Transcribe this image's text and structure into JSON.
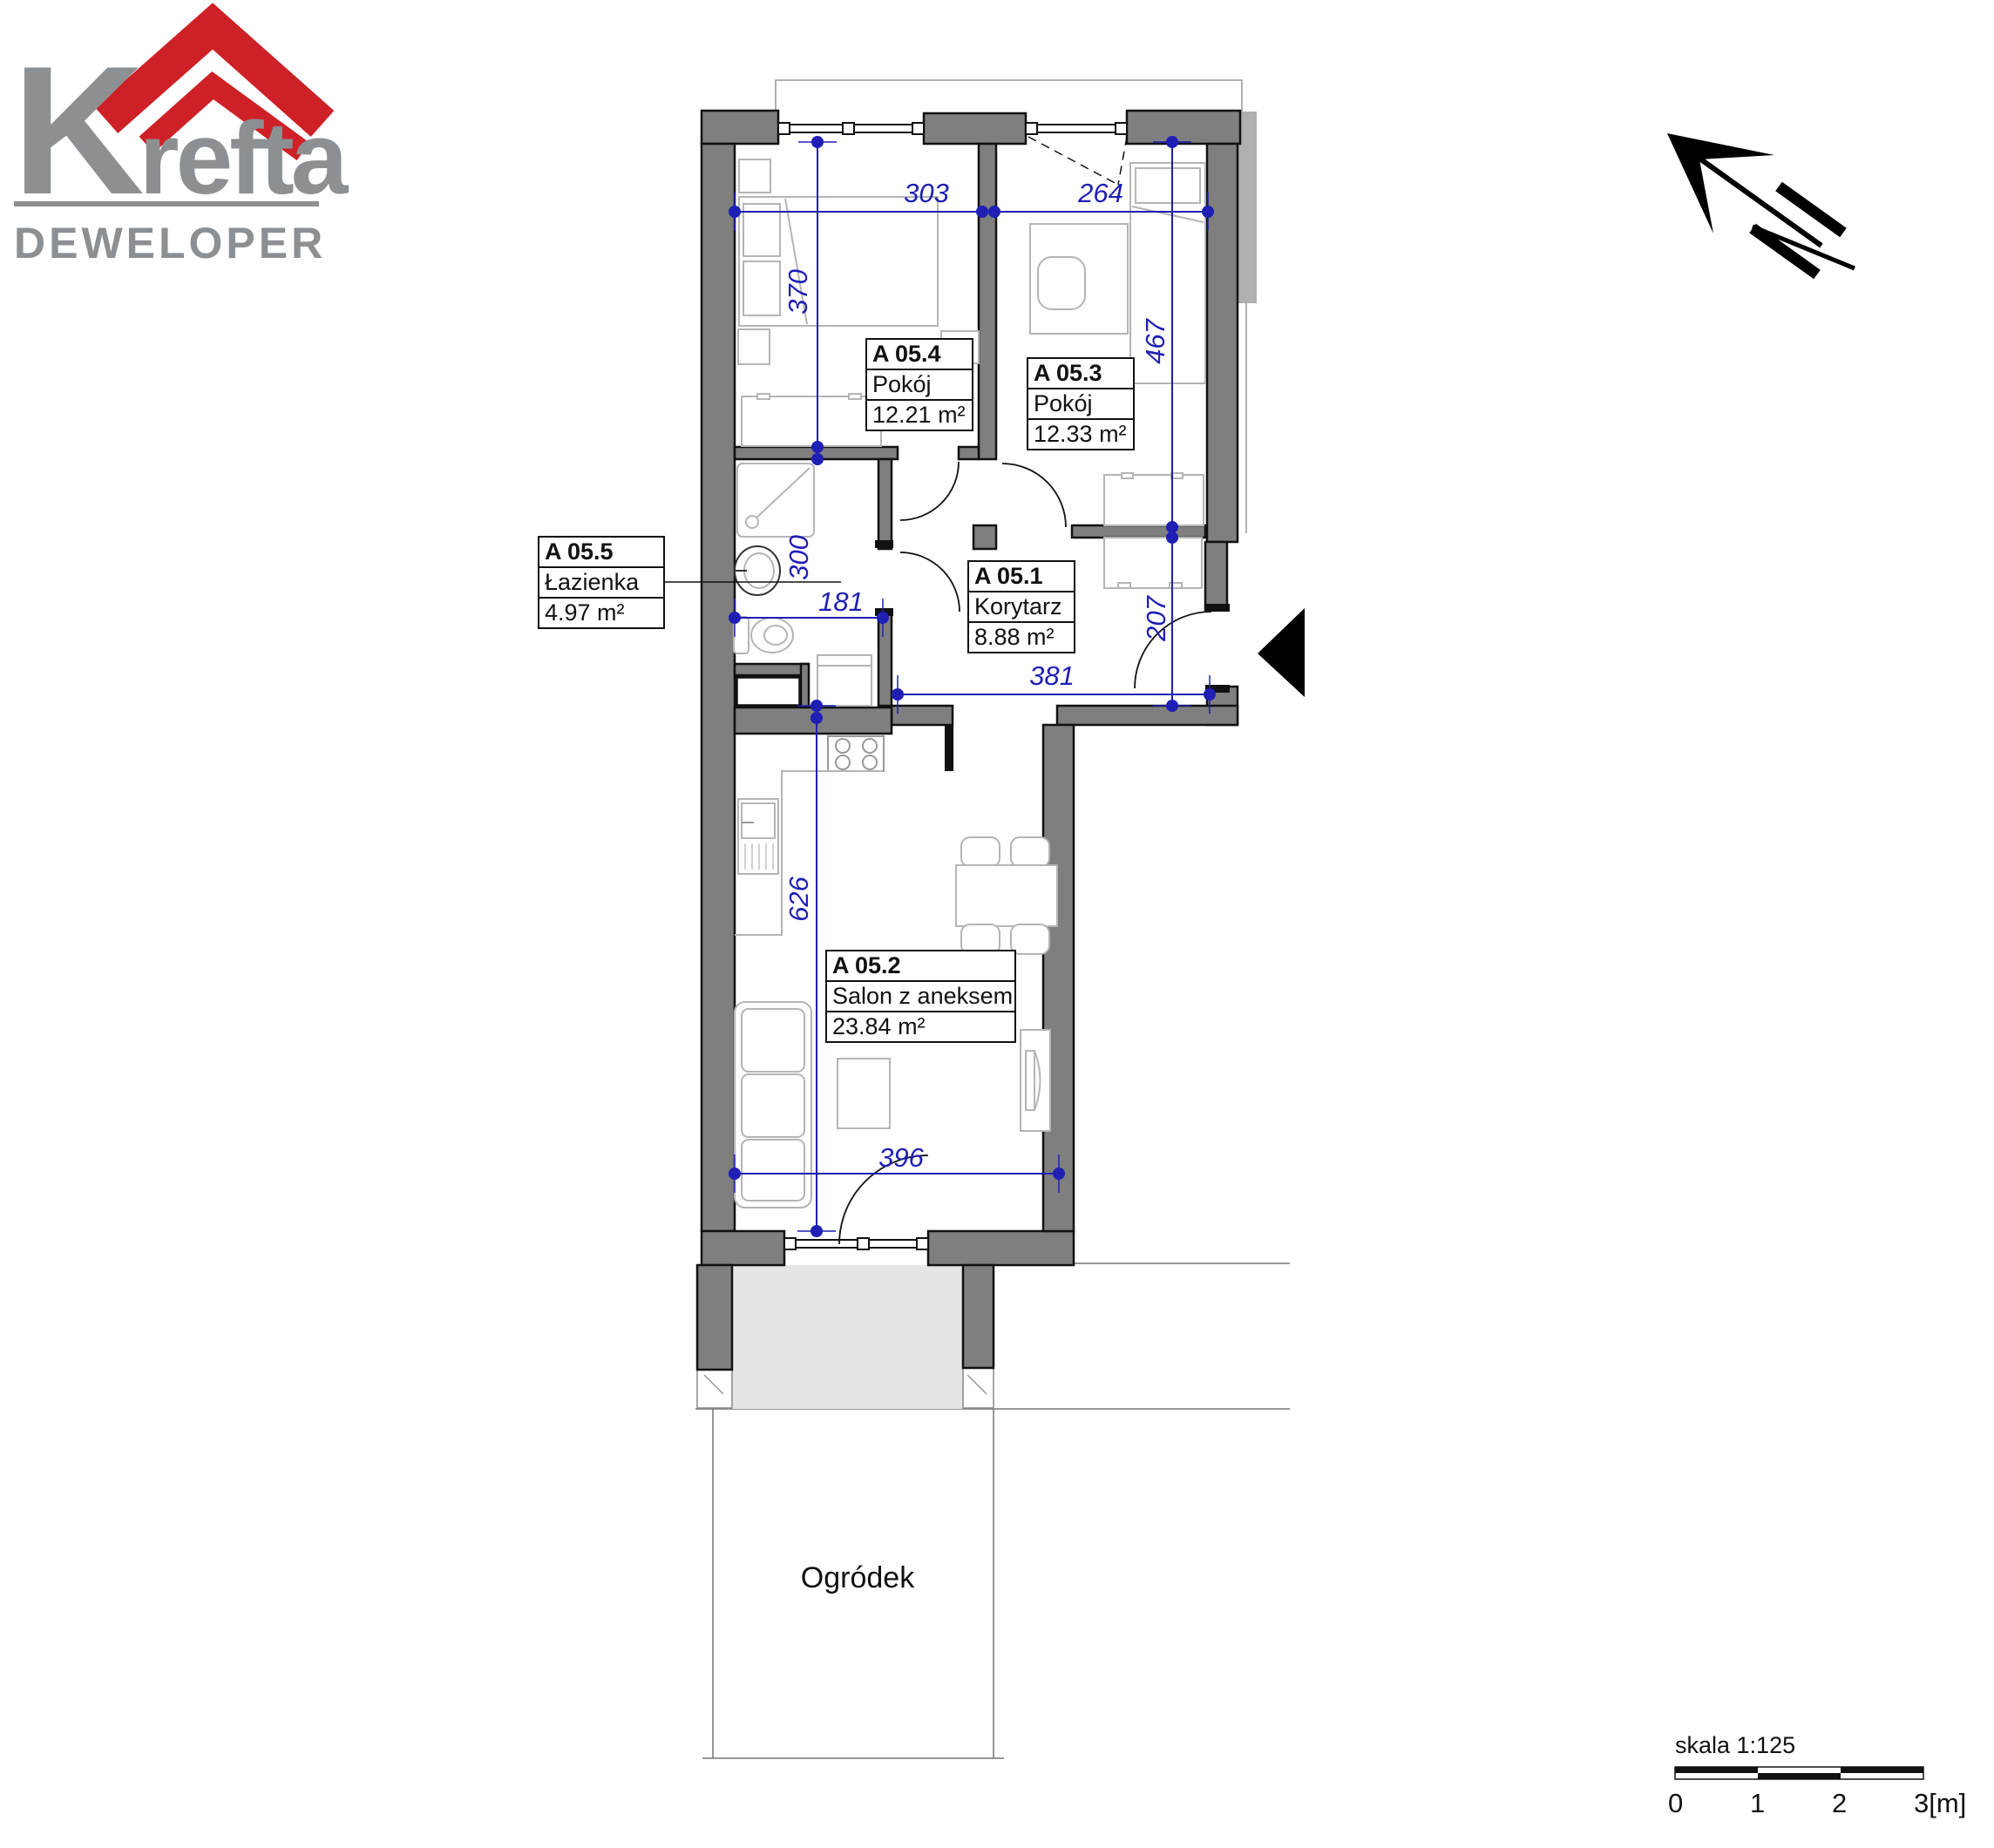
{
  "logo": {
    "brand_k": "K",
    "brand_rest": "refta",
    "subtitle": "DEWELOPER",
    "red": "#cd2127",
    "gray": "#8c9093"
  },
  "plan": {
    "rooms": [
      {
        "id": "A 05.1",
        "name": "Korytarz",
        "area": "8.88 m²"
      },
      {
        "id": "A 05.2",
        "name": "Salon z aneksem",
        "area": "23.84 m²"
      },
      {
        "id": "A 05.3",
        "name": "Pokój",
        "area": "12.33 m²"
      },
      {
        "id": "A 05.4",
        "name": "Pokój",
        "area": "12.21 m²"
      },
      {
        "id": "A 05.5",
        "name": "Łazienka",
        "area": "4.97 m²"
      }
    ],
    "garden_label": "Ogródek",
    "dims": {
      "top_left": "303",
      "top_right": "264",
      "bedroom_left_depth": "370",
      "bedroom_right_depth": "467",
      "bathroom_depth": "300",
      "bathroom_width": "181",
      "entry_depth": "207",
      "corridor_width": "381",
      "salon_depth": "626",
      "salon_width": "396"
    },
    "wall_color": "#7f7f7f",
    "dim_color": "#1f1fb4",
    "terrace_color": "#e5e5e5"
  },
  "scale_bar": {
    "label": "skala 1:125",
    "ticks": [
      "0",
      "1",
      "2",
      "3[m]"
    ]
  }
}
